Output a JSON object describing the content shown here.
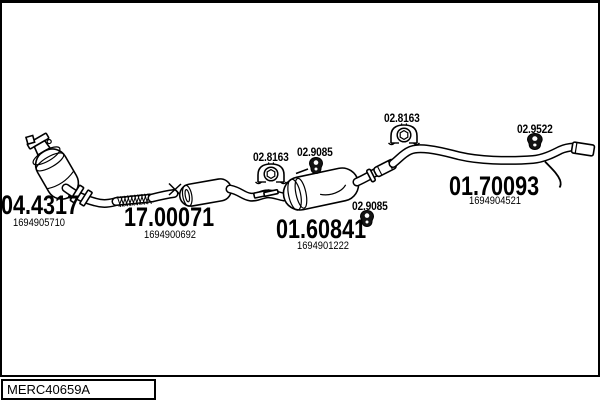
{
  "drawing": {
    "code": "MERC40659A",
    "type": "exhaust-system-parts-diagram",
    "colors": {
      "line": "#000000",
      "background": "#ffffff"
    }
  },
  "parts": {
    "front_pipe": {
      "number": "04.4317",
      "ref": "1694905710"
    },
    "center_pipe": {
      "number": "17.00071",
      "ref": "1694900692"
    },
    "center_muffler": {
      "number": "01.60841",
      "ref": "1694901222"
    },
    "rear_pipe": {
      "number": "01.70093",
      "ref": "1694904521"
    }
  },
  "fittings": {
    "clamp_left": {
      "number": "02.8163",
      "icon": "clamp-icon"
    },
    "hanger_top": {
      "number": "02.9085",
      "icon": "rubber-hanger-icon"
    },
    "hanger_bottom": {
      "number": "02.9085",
      "icon": "rubber-hanger-icon"
    },
    "clamp_right": {
      "number": "02.8163",
      "icon": "clamp-icon"
    },
    "hanger_rear": {
      "number": "02.9522",
      "icon": "rubber-hanger-icon"
    }
  }
}
